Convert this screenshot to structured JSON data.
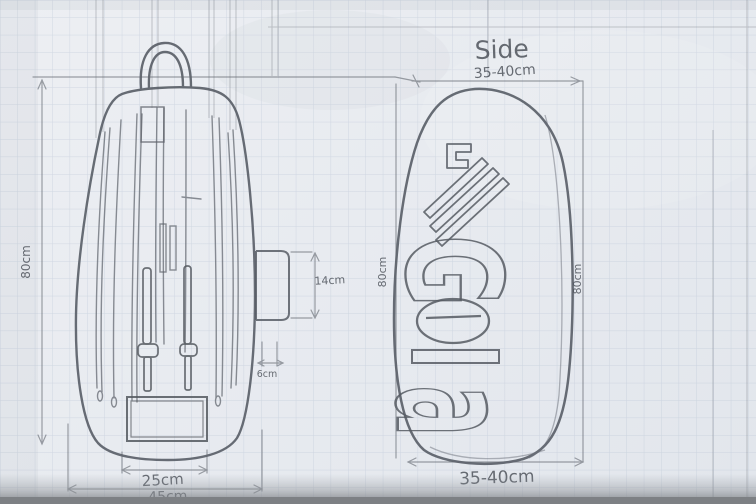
{
  "meta": {
    "description": "Hand-drawn pencil design sketch on graph paper: holdall bag front view and side view with measurements"
  },
  "colors": {
    "paper": "#e9ecf1",
    "grid_line": "#b9c4d4",
    "pencil": "#585d66",
    "pencil_light": "#8b919a",
    "paper_edge": "#83868a"
  },
  "front_view": {
    "dimensions": {
      "height": "80cm",
      "inner_width": "25cm",
      "outer_width": "45cm",
      "pocket_height": "14cm",
      "pocket_width": "6cm"
    }
  },
  "side_view": {
    "title": "Side",
    "logo_text": "Gola",
    "logo_letters": {
      "g": "G",
      "o": "o",
      "l": "l",
      "a": "a"
    },
    "dimensions": {
      "top_width": "35-40cm",
      "bottom_width": "35-40cm",
      "left_height": "80cm",
      "right_height": "80cm"
    }
  }
}
